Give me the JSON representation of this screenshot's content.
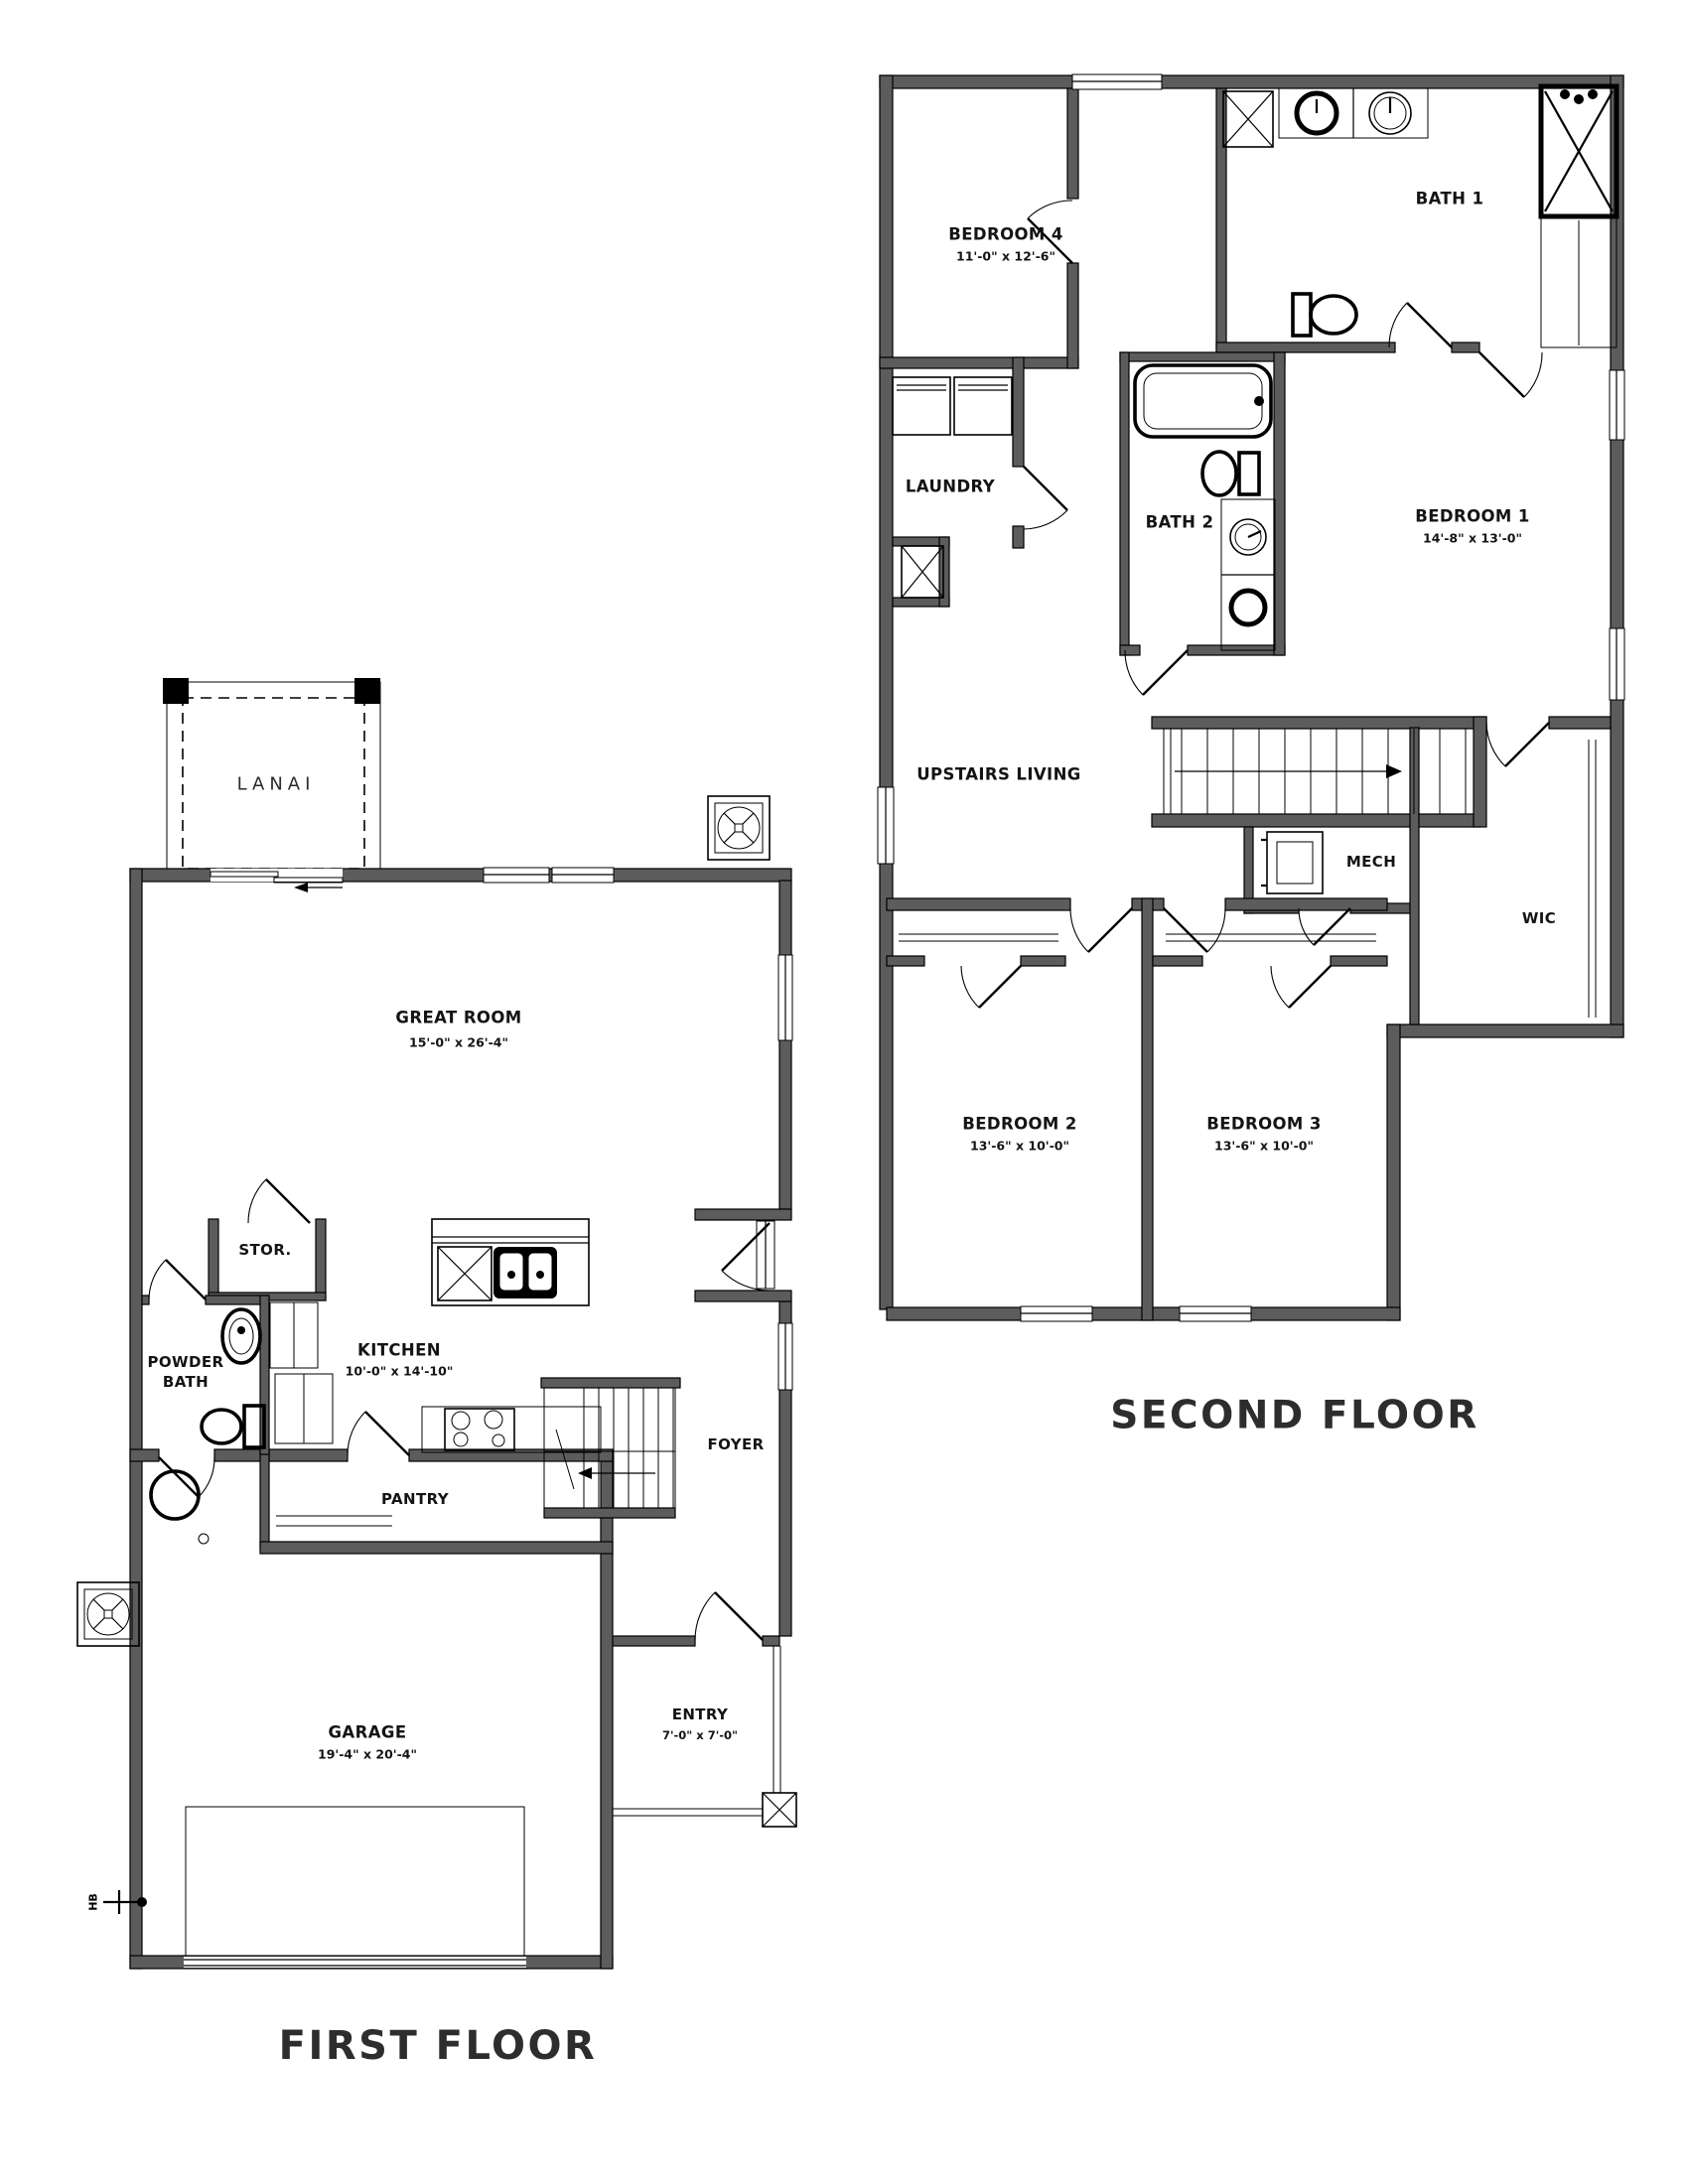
{
  "colors": {
    "wall": "#5c5c5c",
    "line": "#000000",
    "text": "#141414",
    "background": "#ffffff"
  },
  "first_floor": {
    "title": "FIRST FLOOR",
    "rooms": [
      {
        "id": "lanai",
        "label": "LANAI",
        "dims": ""
      },
      {
        "id": "great-room",
        "label": "GREAT ROOM",
        "dims": "15'-0\" x 26'-4\""
      },
      {
        "id": "stor",
        "label": "STOR.",
        "dims": ""
      },
      {
        "id": "powder-bath",
        "label": "POWDER BATH",
        "dims": ""
      },
      {
        "id": "kitchen",
        "label": "KITCHEN",
        "dims": "10'-0\" x 14'-10\""
      },
      {
        "id": "pantry",
        "label": "PANTRY",
        "dims": ""
      },
      {
        "id": "foyer",
        "label": "FOYER",
        "dims": ""
      },
      {
        "id": "entry",
        "label": "ENTRY",
        "dims": "7'-0\" x 7'-0\""
      },
      {
        "id": "garage",
        "label": "GARAGE",
        "dims": "19'-4\" x 20'-4\""
      }
    ],
    "annotations": {
      "hose_bib": "HB"
    }
  },
  "second_floor": {
    "title": "SECOND FLOOR",
    "rooms": [
      {
        "id": "bedroom-4",
        "label": "BEDROOM 4",
        "dims": "11'-0\" x 12'-6\""
      },
      {
        "id": "bath-1",
        "label": "BATH 1",
        "dims": ""
      },
      {
        "id": "laundry",
        "label": "LAUNDRY",
        "dims": ""
      },
      {
        "id": "bath-2",
        "label": "BATH 2",
        "dims": ""
      },
      {
        "id": "bedroom-1",
        "label": "BEDROOM 1",
        "dims": "14'-8\" x 13'-0\""
      },
      {
        "id": "upstairs-living",
        "label": "UPSTAIRS LIVING",
        "dims": ""
      },
      {
        "id": "mech",
        "label": "MECH",
        "dims": ""
      },
      {
        "id": "wic",
        "label": "WIC",
        "dims": ""
      },
      {
        "id": "bedroom-2",
        "label": "BEDROOM 2",
        "dims": "13'-6\" x 10'-0\""
      },
      {
        "id": "bedroom-3",
        "label": "BEDROOM 3",
        "dims": "13'-6\" x 10'-0\""
      }
    ]
  }
}
